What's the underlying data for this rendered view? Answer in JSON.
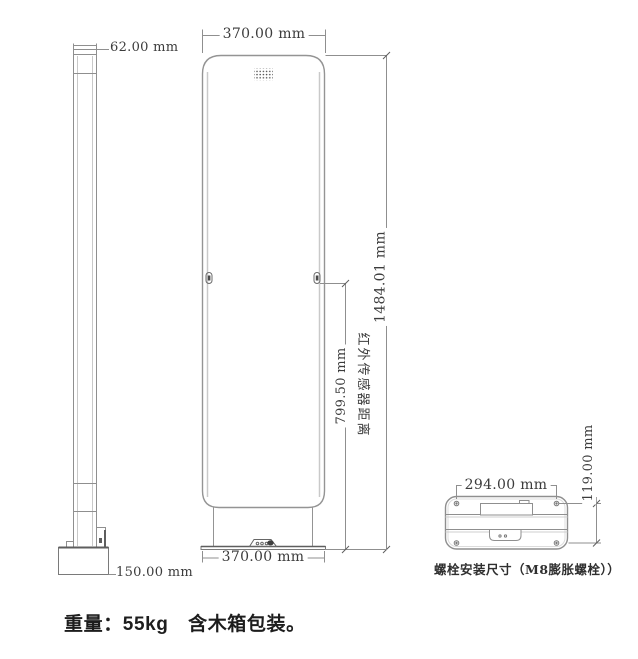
{
  "drawing": {
    "side_view": {
      "top_width_label": "62.00 mm",
      "base_width_label": "150.00 mm"
    },
    "front_view": {
      "top_width_label": "370.00 mm",
      "bottom_width_label": "370.00 mm",
      "height_label": "1484.01 mm",
      "ir_sensor_height_label": "799.50 mm",
      "ir_sensor_text": "红外传感器距离"
    },
    "base_view": {
      "hole_spacing_width_label": "294.00 mm",
      "hole_spacing_depth_label": "119.00 mm",
      "caption": "螺栓安装尺寸（M8膨胀螺栓））"
    },
    "footer": {
      "weight_note": "重量：55kg　含木箱包装。"
    },
    "colors": {
      "line": "#8f8f8f",
      "line_dark": "#5e5e5e",
      "line_light": "#c9c9c9",
      "dim_text": "#3c3c3c",
      "footer_text": "#1d1d1d",
      "background": "#ffffff"
    }
  }
}
